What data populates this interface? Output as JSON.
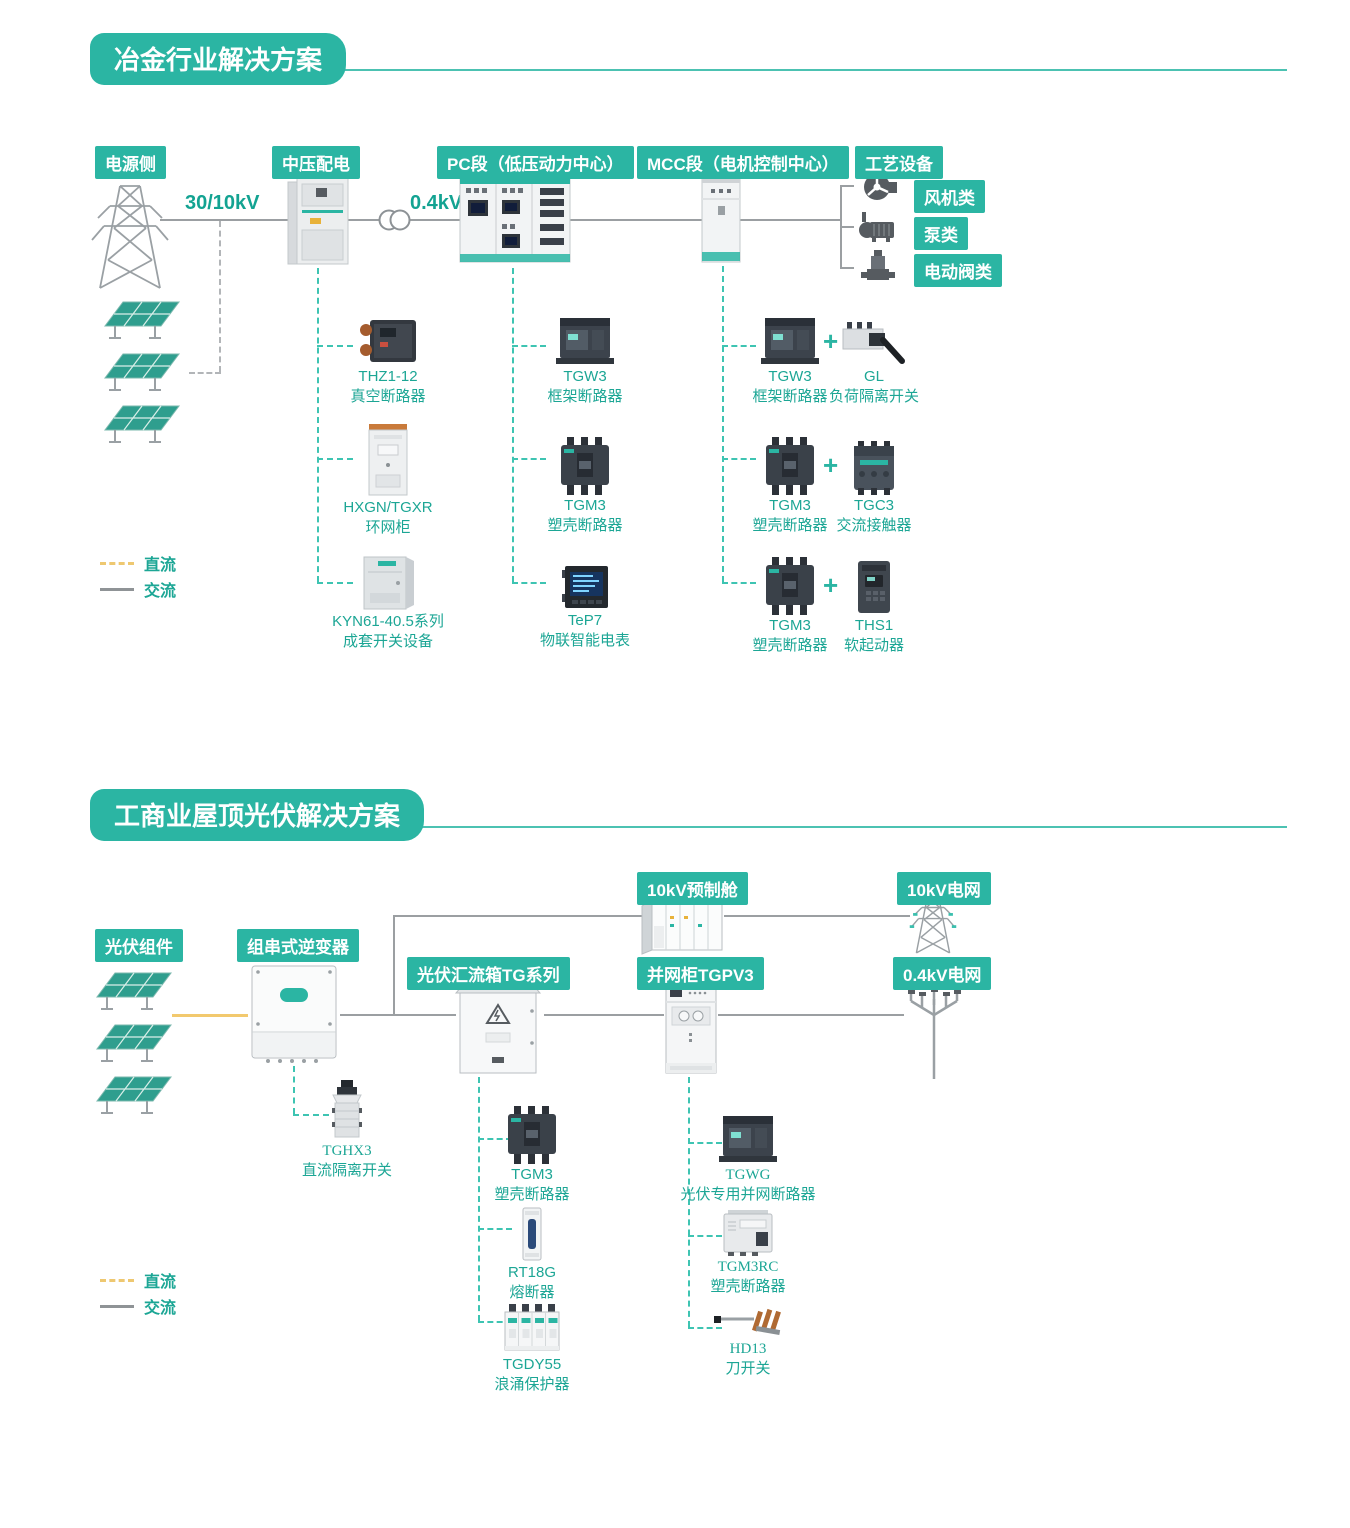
{
  "colors": {
    "teal": "#2bb5a3",
    "teal_text": "#1ca695",
    "ac_gray": "#9b9fa2",
    "dc_yellow": "#f2c96e"
  },
  "section1": {
    "title": "冶金行业解决方案",
    "nodes": {
      "source": "电源侧",
      "mv": "中压配电",
      "pc": "PC段（低压动力中心）",
      "mcc": "MCC段（电机控制中心）",
      "process": "工艺设备"
    },
    "voltage_mv": "30/10kV",
    "voltage_lv": "0.4kV",
    "process_loads": [
      {
        "label": "风机类"
      },
      {
        "label": "泵类"
      },
      {
        "label": "电动阀类"
      }
    ],
    "mv_products": [
      {
        "name": "THZ1-12",
        "desc": "真空断路器"
      },
      {
        "name": "HXGN/TGXR",
        "desc": "环网柜"
      },
      {
        "name": "KYN61-40.5系列",
        "desc": "成套开关设备"
      }
    ],
    "pc_products": [
      {
        "name": "TGW3",
        "desc": "框架断路器"
      },
      {
        "name": "TGM3",
        "desc": "塑壳断路器"
      },
      {
        "name": "TeP7",
        "desc": "物联智能电表"
      }
    ],
    "mcc_products": [
      {
        "a": {
          "name": "TGW3",
          "desc": "框架断路器"
        },
        "plus": "+",
        "b": {
          "name": "GL",
          "desc": "负荷隔离开关"
        }
      },
      {
        "a": {
          "name": "TGM3",
          "desc": "塑壳断路器"
        },
        "plus": "+",
        "b": {
          "name": "TGC3",
          "desc": "交流接触器"
        }
      },
      {
        "a": {
          "name": "TGM3",
          "desc": "塑壳断路器"
        },
        "plus": "+",
        "b": {
          "name": "THS1",
          "desc": "软起动器"
        }
      }
    ],
    "legend": {
      "dc": "直流",
      "ac": "交流"
    }
  },
  "section2": {
    "title": "工商业屋顶光伏解决方案",
    "nodes": {
      "pv": "光伏组件",
      "inverter": "组串式逆变器",
      "combiner": "光伏汇流箱TG系列",
      "grid_cabinet": "并网柜TGPV3",
      "prefab": "10kV预制舱",
      "grid_10kv": "10kV电网",
      "grid_04kv": "0.4kV电网"
    },
    "inverter_products": [
      {
        "name": "TGHX3",
        "desc": "直流隔离开关"
      }
    ],
    "combiner_products": [
      {
        "name": "TGM3",
        "desc": "塑壳断路器"
      },
      {
        "name": "RT18G",
        "desc": "熔断器"
      },
      {
        "name": "TGDY55",
        "desc": "浪涌保护器"
      }
    ],
    "grid_products": [
      {
        "name": "TGWG",
        "desc": "光伏专用并网断路器"
      },
      {
        "name": "TGM3RC",
        "desc": "塑壳断路器"
      },
      {
        "name": "HD13",
        "desc": "刀开关"
      }
    ],
    "legend": {
      "dc": "直流",
      "ac": "交流"
    }
  }
}
